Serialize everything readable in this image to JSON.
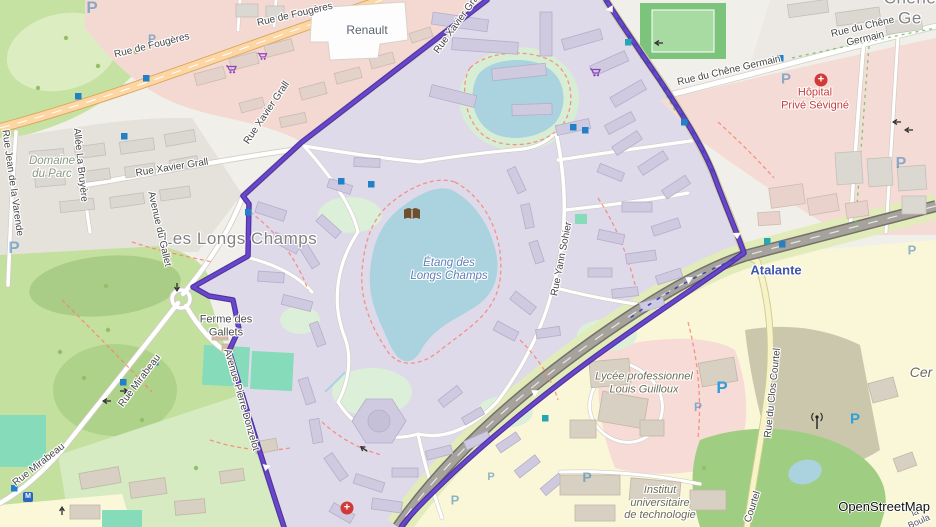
{
  "map": {
    "attribution": "OpenStreetMap",
    "labels": {
      "rue_de_fougeres_w": "Rue de Fougères",
      "rue_de_fougeres_e": "Rue de Fougères",
      "renault": "Renault",
      "rue_xavier_grall_diag_w": "Rue Xavier Grall",
      "rue_xavier_grall_horiz": "Rue Xavier Grall",
      "rue_xavier_grall_diag_n": "Rue Xavier Grall",
      "allee_la_bruyere": "Allée La Bruyère",
      "rue_jean_de_la_varende": "Rue Jean de la Varende",
      "domaine_du_parc": "Domaine\ndu Parc",
      "les_longs_champs": "Les Longs Champs",
      "avenue_du_gallet": "Avenue du Gallet",
      "rue_mirabeau_n": "Rue Mirabeau",
      "rue_mirabeau_s": "Rue Mirabeau",
      "avenue_pierre_donzelot": "Avenue Pierre Donzelot",
      "ferme_des_gallets": "Ferme des\nGallets",
      "etang_des_longs_champs": "Étang des\nLongs Champs",
      "rue_yann_sohier": "Rue Yann Sohier",
      "rue_du_chene_germain_w": "Rue du Chêne Germain",
      "rue_du_chene_germain_e": "Rue du Chêne Germain",
      "chene_germain_place": "Chêne Ge",
      "hopital_prive_sevigne": "Hôpital\nPrivé Sévigné",
      "atalante": "Atalante",
      "lycee": "Lycée professionnel\nLouis Guilloux",
      "iut": "Institut\nuniversitaire\nde technologie",
      "rue_du_clos_courtel": "Rue du Clos Courtel",
      "courtel_partial": "Courtel",
      "cer_partial": "Cer",
      "la_boulais_partial": "la Boula"
    },
    "icons": {
      "parking_glyph": "P",
      "metro_glyph": "M",
      "hospital_glyph": "+"
    },
    "colors": {
      "boundary_purple": "#5b3fbe",
      "water": "#aad3df",
      "park_green": "#c6e2a2",
      "residential_inside": "#dedae9",
      "retail_pink": "#f3d9d2",
      "campus_yellow": "#faf6d8",
      "pitch_teal": "#86dcba",
      "primary_road": "#fcd6a4"
    }
  }
}
